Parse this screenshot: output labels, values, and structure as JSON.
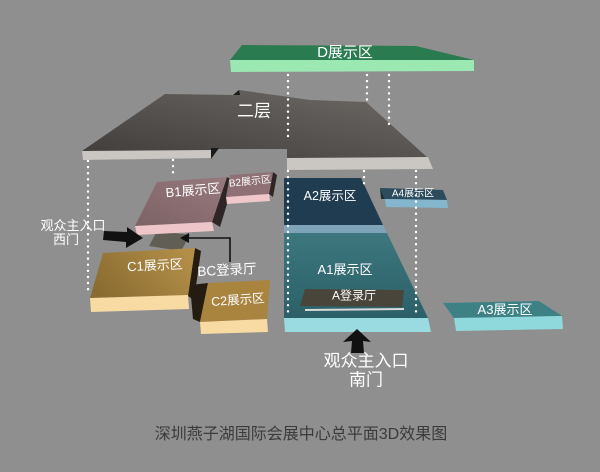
{
  "canvas": {
    "width": 600,
    "height": 472
  },
  "caption": "深圳燕子湖国际会展中心总平面3D效果图",
  "areas": {
    "d": {
      "label": "D展示区"
    },
    "second_floor": {
      "label": "二层"
    },
    "b1": {
      "label": "B1展示区"
    },
    "b2": {
      "label": "B2展示区"
    },
    "c1": {
      "label": "C1展示区"
    },
    "c2": {
      "label": "C2展示区"
    },
    "bc_hall": {
      "label": "BC登录厅"
    },
    "a1": {
      "label": "A1展示区"
    },
    "a2": {
      "label": "A2展示区"
    },
    "a3": {
      "label": "A3展示区"
    },
    "a4": {
      "label": "A4展示区"
    },
    "a_hall": {
      "label": "A登录厅"
    }
  },
  "entrances": {
    "west": {
      "line1": "观众主入口",
      "line2": "西门"
    },
    "south": {
      "line1": "观众主入口",
      "line2": "南门"
    }
  },
  "colors": {
    "background": "#8f8f8f",
    "roof_a": "#403d3b",
    "roof_b": "#6e6a66",
    "ledge": "#cac7c3",
    "notch_dark": "#1b1a19",
    "d_top": "#2a7c50",
    "d_front": "#9ce8b2",
    "b1_a": "#7c6165",
    "b1_b": "#977a7e",
    "b1_front": "#eec6ca",
    "b1_side": "#2e2527",
    "b2_top": "#8f7175",
    "b2_front": "#f0c7cb",
    "c1_a": "#8a6c31",
    "c1_b": "#b28e48",
    "c2_top": "#a8843f",
    "c_front": "#f8dba3",
    "c_side": "#241c10",
    "walkway": "#615e55",
    "a2_top": "#203c50",
    "a2_front": "#7fa3b8",
    "a1_top_a": "#3d777e",
    "a1_top_b": "#2c6068",
    "a1_front": "#99dbe0",
    "a4_top": "#2c4c5d",
    "a4_front": "#84b7cd",
    "a4_side": "#1e2f3a",
    "a3_top": "#3d8185",
    "a3_front": "#8fd9dd",
    "hall": "#4a453b",
    "hall_underline": "#d9d9d9",
    "dotted_line": "#ffffff",
    "ink": "#111111",
    "caption_text": "#3b3b3b"
  }
}
